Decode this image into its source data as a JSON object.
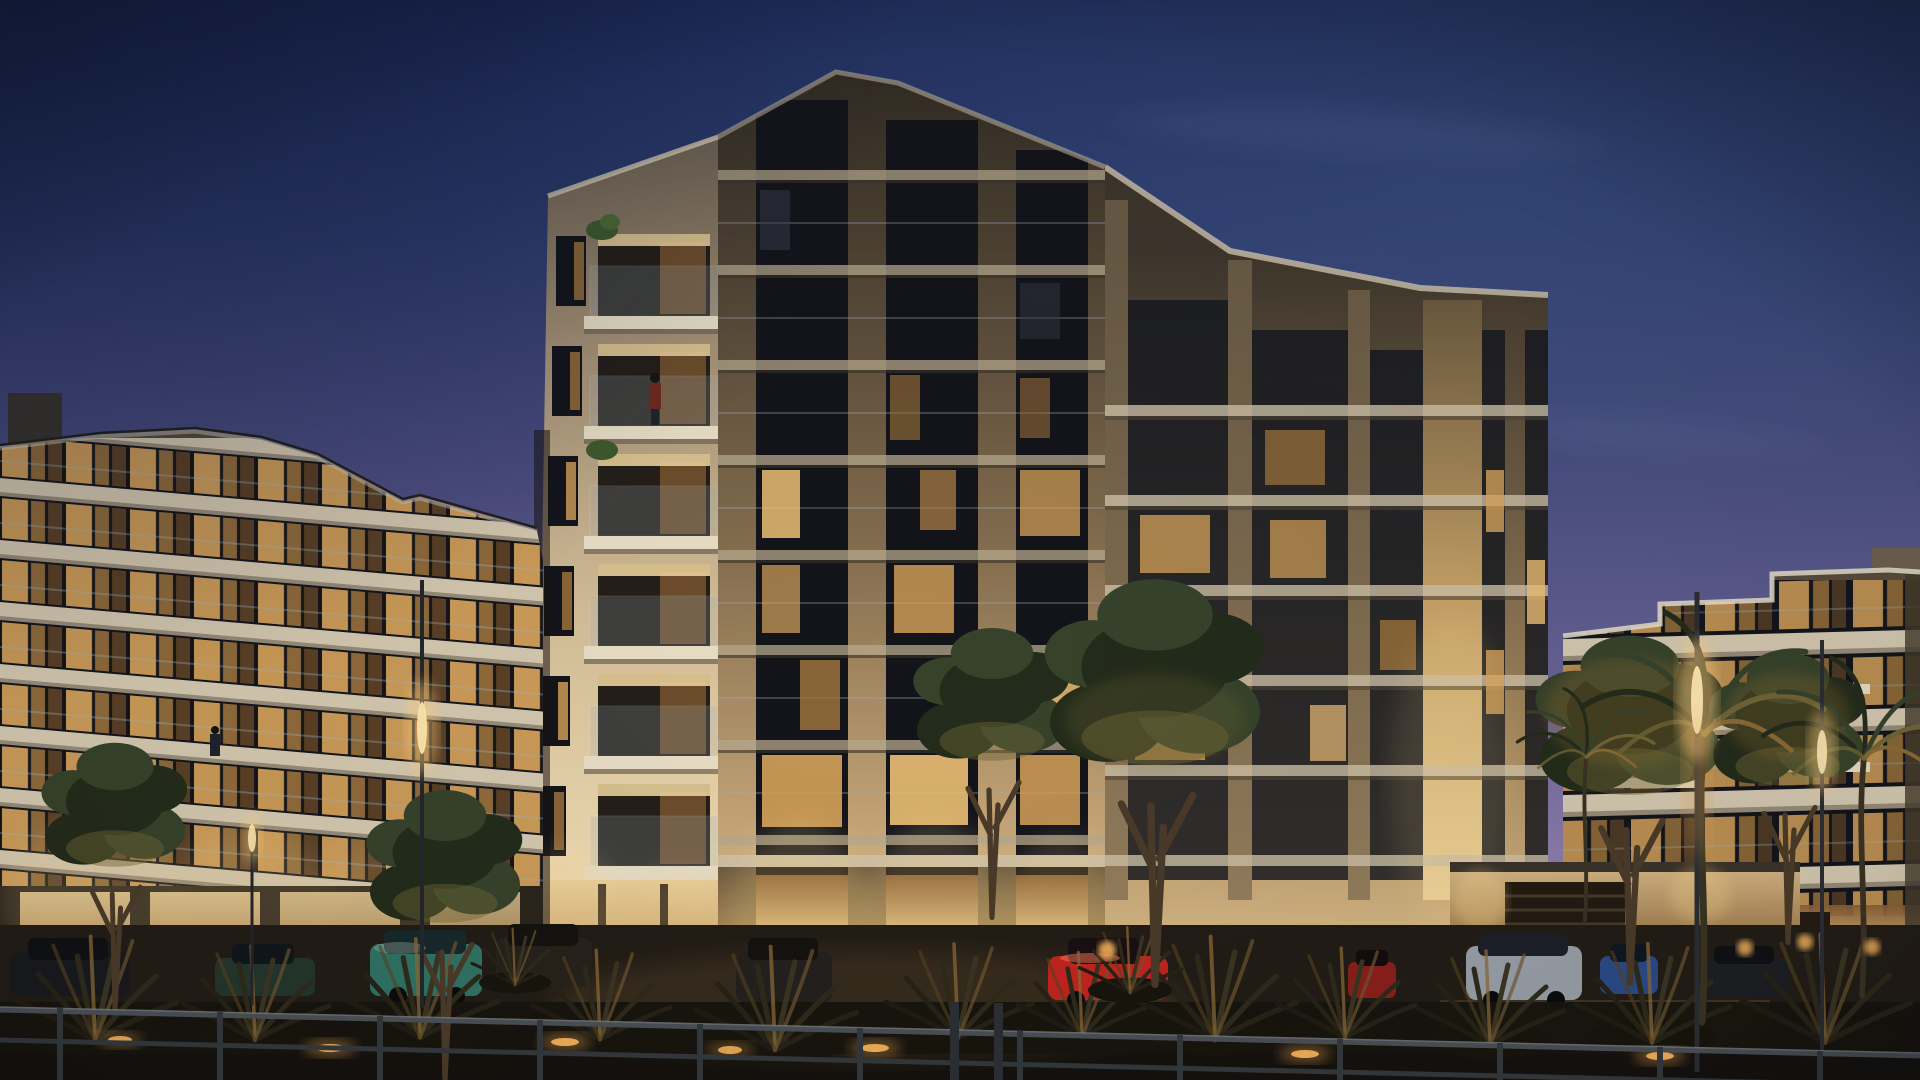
{
  "scene": {
    "type": "architectural-rendering",
    "time_of_day": "dusk",
    "subject": "Modern low-rise luxury apartment complex with warm illuminated interiors, landscaped forecourt, parked cars, street lamps and a perimeter railing under a clear dusk sky",
    "elements": [
      "dusk sky",
      "left residential wing",
      "central tower with corner balconies and glass balustrades",
      "right residential wing with stepped roofline",
      "balcony plants",
      "trees",
      "palm trees",
      "agave shrubs",
      "hedge",
      "parked cars",
      "street lamps",
      "garden bollard lights",
      "compound wall with garage",
      "metal railing fence",
      "wet pavement with ground lights"
    ]
  },
  "colors": {
    "sky_top": "#1d2a5b",
    "sky_upper": "#2e3b6e",
    "sky_mid": "#4c4d80",
    "sky_lower": "#6f6699",
    "sky_horizon": "#9886b4",
    "sky_haze": "#a897c1",
    "cloud": "#ccd3ec",
    "facade_lit": "#d9c7a4",
    "facade_shadow": "#55493a",
    "slab": "#d3c7ae",
    "slab_shadow": "#6e6353",
    "pier_gold": "#d8b47c",
    "glass_dark": "#14151b",
    "window_warm": "#d9a55c",
    "window_bright": "#f0c277",
    "window_dim": "#a5793f",
    "soffit_glow": "#ecd29b",
    "railing_glass": "#9fb0bd",
    "lamp_glow": "#ffcf7e",
    "ground_light": "#ffb95e",
    "glow_warm": "#ffd98e",
    "foliage_dark": "#232b1a",
    "foliage_mid": "#36422a",
    "foliage_warm": "#6f6535",
    "trunk": "#4a3a28",
    "shrub_warm": "#8a6a36",
    "ground": "#221c15",
    "pavement": "#14110d",
    "fence": "#494f54",
    "fence_dark": "#33383c",
    "fence_light": "#7a8187",
    "wall_warm": "#c9a878",
    "car_red": "#c0241e",
    "car_teal": "#2f7264",
    "car_silver": "#979ea6",
    "car_blue": "#2c4a86",
    "car_dark": "#17191d",
    "car_green": "#24352a"
  }
}
